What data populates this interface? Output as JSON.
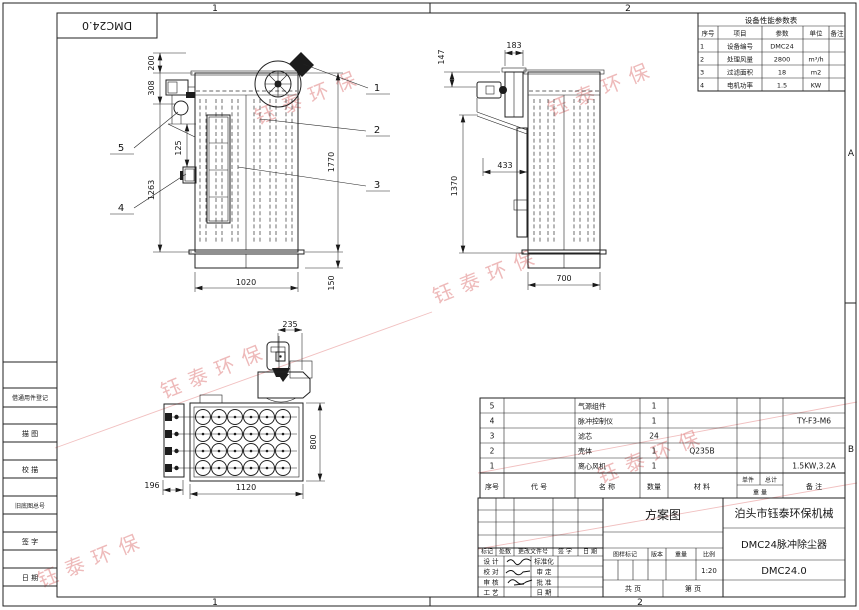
{
  "sheet": {
    "corner_label": "DMC24.0",
    "zones": {
      "top": [
        "1",
        "2"
      ],
      "bottom": [
        "1",
        "2"
      ],
      "right": [
        "A",
        "B"
      ]
    }
  },
  "left_strip": {
    "labels": [
      "借通用件登记",
      "描 图",
      "校 描",
      "旧底图总号",
      "签 字",
      "日 期"
    ]
  },
  "watermark": {
    "text": "钰泰环保",
    "color": "#de7676"
  },
  "perf_table": {
    "title": "设备性能参数表",
    "headers": [
      "序号",
      "项目",
      "参数",
      "单位",
      "备注"
    ],
    "rows": [
      {
        "no": "1",
        "item": "设备编号",
        "value": "DMC24",
        "unit": "",
        "note": ""
      },
      {
        "no": "2",
        "item": "处理风量",
        "value": "2800",
        "unit": "m³/h",
        "note": ""
      },
      {
        "no": "3",
        "item": "过滤面积",
        "value": "18",
        "unit": "m2",
        "note": ""
      },
      {
        "no": "4",
        "item": "电机功率",
        "value": "1.5",
        "unit": "KW",
        "note": ""
      }
    ]
  },
  "front_view": {
    "dims": {
      "d200": "200",
      "d308": "308",
      "d125": "125",
      "d1263": "1263",
      "d1770": "1770",
      "d1020": "1020",
      "d150": "150"
    },
    "callouts": {
      "c1": "1",
      "c2": "2",
      "c3": "3",
      "c4": "4",
      "c5": "5"
    }
  },
  "side_view": {
    "dims": {
      "d147": "147",
      "d183": "183",
      "d433": "433",
      "d1370": "1370",
      "d700": "700"
    }
  },
  "plan_view": {
    "dims": {
      "d235": "235",
      "d800": "800",
      "d196": "196",
      "d1120": "1120"
    }
  },
  "parts_table": {
    "headers": {
      "no": "序号",
      "code": "代  号",
      "name": "名  称",
      "qty": "数量",
      "material": "材  料",
      "unit": "单件",
      "total": "总计",
      "weight": "重  量",
      "note": "备  注"
    },
    "rows": [
      {
        "no": "5",
        "code": "",
        "name": "气源组件",
        "qty": "1",
        "material": "",
        "note": ""
      },
      {
        "no": "4",
        "code": "",
        "name": "脉冲控制仪",
        "qty": "1",
        "material": "",
        "note": "TY-F3-M6"
      },
      {
        "no": "3",
        "code": "",
        "name": "滤芯",
        "qty": "24",
        "material": "",
        "note": ""
      },
      {
        "no": "2",
        "code": "",
        "name": "壳体",
        "qty": "1",
        "material": "Q235B",
        "note": ""
      },
      {
        "no": "1",
        "code": "",
        "name": "离心风机",
        "qty": "1",
        "material": "",
        "note": "1.5KW,3.2A"
      }
    ]
  },
  "title_block": {
    "doc_type": "方案图",
    "company": "泊头市钰泰环保机械",
    "product": "DMC24脉冲除尘器",
    "drawing_no": "DMC24.0",
    "rev_headers": [
      "标记",
      "处数",
      "更改文件号",
      "签 字",
      "日 期"
    ],
    "sig_rows": [
      {
        "left": "设 计",
        "right": "标准化"
      },
      {
        "left": "校 对",
        "right": "审 定"
      },
      {
        "left": "审 核",
        "right": "批 准"
      },
      {
        "left": "工 艺",
        "right": "日 期"
      }
    ],
    "stamp_headers": [
      "图样标记",
      "版本",
      "重量",
      "比例"
    ],
    "scale": "1:20",
    "pages": {
      "left": "共  页",
      "right": "第  页"
    }
  }
}
